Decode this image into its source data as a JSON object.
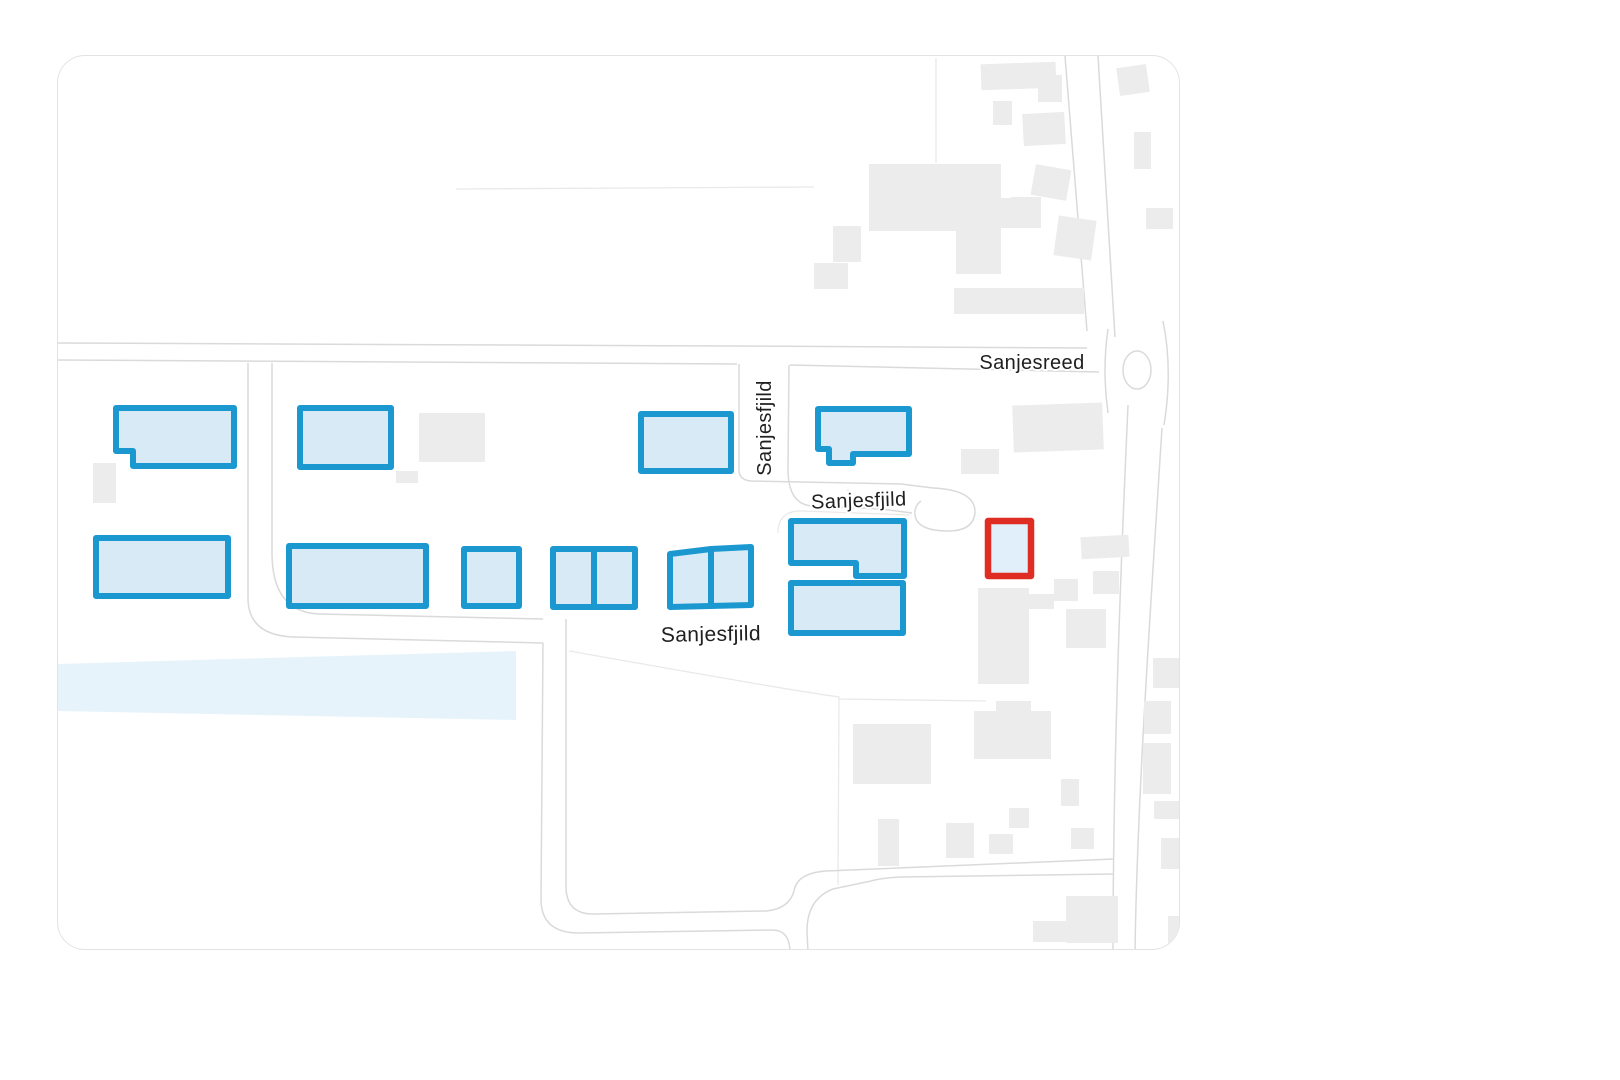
{
  "map": {
    "colors": {
      "page_background": "#ffffff",
      "card_border": "#e3e3e3",
      "highlight_stroke": "#1b98d0",
      "highlight_fill": "#d8eaf6",
      "selected_stroke": "#e02d24",
      "selected_fill": "#e0effa",
      "building_fill": "#ececec",
      "road_casing": "#dadada",
      "parcel_line": "#e9e9e9",
      "water_fill": "#e6f3fb",
      "label_color": "#202020"
    },
    "labels": [
      {
        "text": "Sanjesreed",
        "x": 1031,
        "y": 368,
        "rotate": 0,
        "size": 20
      },
      {
        "text": "Sanjesfjild",
        "x": 770,
        "y": 427,
        "rotate": -90,
        "size": 20
      },
      {
        "text": "Sanjesfjild",
        "x": 858,
        "y": 506,
        "rotate": -2,
        "size": 20
      },
      {
        "text": "Sanjesfjild",
        "x": 710,
        "y": 640,
        "rotate": -1,
        "size": 21
      }
    ],
    "water": {
      "points": "57,663 515,650 515,719 57,710"
    },
    "highlighted_buildings": [
      {
        "points": "115,407 233,407 233,465 132,465 132,450 115,450"
      },
      {
        "points": "299,407 390,407 390,466 299,466"
      },
      {
        "points": "640,413 730,413 730,470 640,470"
      },
      {
        "points": "817,408 908,408 908,453 852,453 852,462 828,462 828,448 817,448"
      },
      {
        "points": "95,537 227,537 227,595 95,595"
      },
      {
        "points": "288,545 425,545 425,605 288,605"
      },
      {
        "points": "463,548 518,548 518,605 463,605"
      },
      {
        "points": "552,548 634,548 634,606 552,606",
        "divider": [
          593,
          548,
          593,
          606
        ]
      },
      {
        "points": "669,553 710,548 750,546 750,604 669,606",
        "divider": [
          710,
          548,
          710,
          605
        ]
      },
      {
        "points": "790,520 903,520 903,575 855,575 855,562 790,562"
      },
      {
        "points": "790,582 902,582 902,632 790,632"
      }
    ],
    "selected_building": {
      "points": "987,520 1030,520 1030,575 987,575"
    },
    "buildings": [
      [
        980,
        62,
        75,
        26,
        -2
      ],
      [
        1037,
        74,
        24,
        27,
        0
      ],
      [
        992,
        100,
        19,
        24,
        0
      ],
      [
        1022,
        112,
        42,
        32,
        -3
      ],
      [
        1117,
        65,
        30,
        28,
        -8
      ],
      [
        1133,
        131,
        17,
        37,
        0
      ],
      [
        1145,
        207,
        27,
        21,
        0
      ],
      [
        868,
        163,
        132,
        67,
        0
      ],
      [
        955,
        230,
        45,
        43,
        0
      ],
      [
        1000,
        197,
        22,
        30,
        0
      ],
      [
        832,
        225,
        28,
        36,
        0
      ],
      [
        813,
        262,
        34,
        26,
        0
      ],
      [
        1032,
        166,
        36,
        31,
        10
      ],
      [
        1010,
        196,
        30,
        31,
        0
      ],
      [
        1055,
        217,
        38,
        40,
        8
      ],
      [
        953,
        287,
        130,
        26,
        0
      ],
      [
        418,
        412,
        66,
        49,
        0
      ],
      [
        92,
        462,
        23,
        40,
        0
      ],
      [
        395,
        470,
        22,
        12,
        0
      ],
      [
        1012,
        403,
        90,
        47,
        -2
      ],
      [
        960,
        448,
        38,
        25,
        0
      ],
      [
        1080,
        535,
        48,
        22,
        -3
      ],
      [
        1092,
        570,
        26,
        23,
        0
      ],
      [
        1053,
        578,
        24,
        22,
        0
      ],
      [
        977,
        587,
        51,
        96,
        0
      ],
      [
        1020,
        593,
        33,
        15,
        0
      ],
      [
        1065,
        608,
        40,
        39,
        0
      ],
      [
        852,
        723,
        78,
        60,
        0
      ],
      [
        973,
        710,
        77,
        48,
        0
      ],
      [
        995,
        700,
        35,
        12,
        0
      ],
      [
        1060,
        778,
        18,
        27,
        0
      ],
      [
        1008,
        807,
        20,
        20,
        0
      ],
      [
        877,
        818,
        21,
        47,
        0
      ],
      [
        945,
        822,
        28,
        35,
        0
      ],
      [
        988,
        833,
        24,
        20,
        0
      ],
      [
        1070,
        827,
        23,
        21,
        0
      ],
      [
        1032,
        920,
        35,
        21,
        0
      ],
      [
        1065,
        895,
        52,
        47,
        0
      ],
      [
        1152,
        657,
        28,
        30,
        0
      ],
      [
        1143,
        700,
        27,
        33,
        0
      ],
      [
        1142,
        742,
        28,
        51,
        0
      ],
      [
        1153,
        800,
        27,
        18,
        0
      ],
      [
        1160,
        837,
        20,
        31,
        0
      ],
      [
        1167,
        915,
        16,
        32,
        0
      ]
    ],
    "roads": [
      "M57,342 L730,345 L1086,347",
      "M57,359 L736,363",
      "M789,364 L1098,371",
      "M738,363 L738,469 Q738,479 750,480 L900,483 L932,487",
      "M788,364 L787,468 Q787,504 812,505 L880,508 L911,512",
      "M932,487 Q975,489 974,512 Q972,531 944,530 Q916,529 914,514 Q913,505 920,500",
      "M247,362 L247,597 Q247,634 292,636 L542,642",
      "M271,362 L271,552 Q271,611 318,613 L542,618",
      "M542,642 L540,898 Q540,932 578,932 L770,929 Q789,928 789,952",
      "M565,618 L565,885 Q565,913 592,913 L765,910 Q788,908 793,890 Q796,872 825,870 L1113,858",
      "M807,952 L806,930 Q806,898 832,888 L870,880 Q880,877 900,876 L1113,873",
      "M1064,55 L1086,330",
      "M1097,55 L1114,336",
      "M1127,404 C1120,560 1112,760 1112,952",
      "M1161,427 C1150,600 1136,800 1134,952",
      "M1107,328 Q1101,369 1107,412",
      "M1162,320 Q1172,369 1163,424"
    ],
    "roundabout": {
      "cx": 1136,
      "cy": 369,
      "rx": 14,
      "ry": 19
    },
    "parcel_lines": [
      "M455,188 L813,186",
      "M935,57 L935,162",
      "M568,650 C660,666 780,688 838,696 L837,884",
      "M838,698 L985,700",
      "M777,532 Q777,509 802,510 L908,514",
      "M847,488 L847,508",
      "M883,490 L883,510"
    ]
  }
}
